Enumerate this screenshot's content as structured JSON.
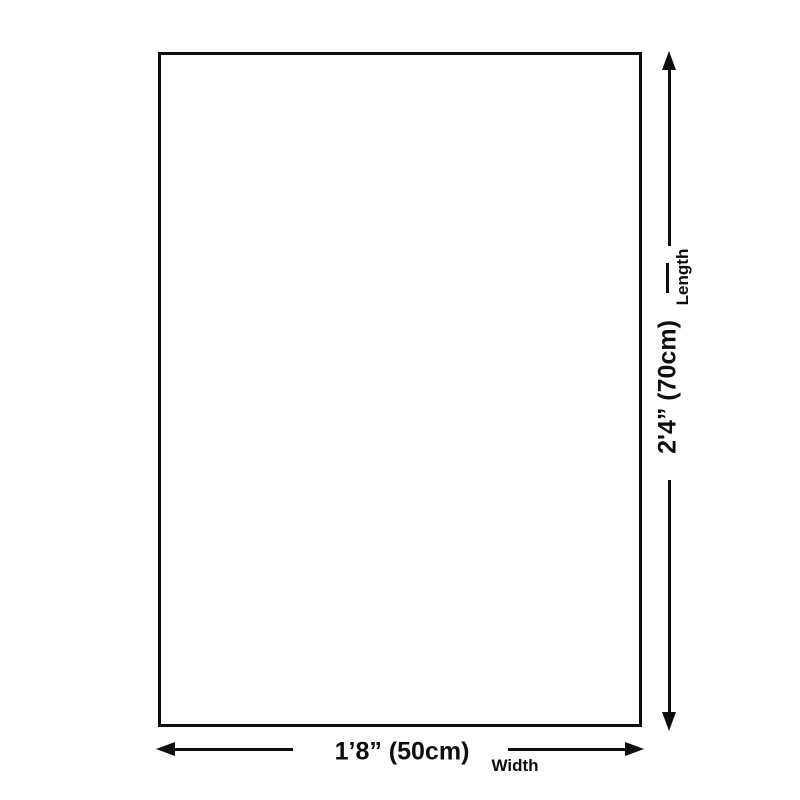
{
  "diagram": {
    "background_color": "#ffffff",
    "line_color": "#0e0e0e",
    "product": {
      "shape": "rectangle",
      "fill": "#ffffff",
      "border_color": "#0e0e0e"
    },
    "length_dimension": {
      "value": "2'4” (70cm)",
      "label": "Length",
      "orientation": "vertical"
    },
    "width_dimension": {
      "value": "1’8” (50cm)",
      "label": "Width",
      "orientation": "horizontal"
    }
  }
}
